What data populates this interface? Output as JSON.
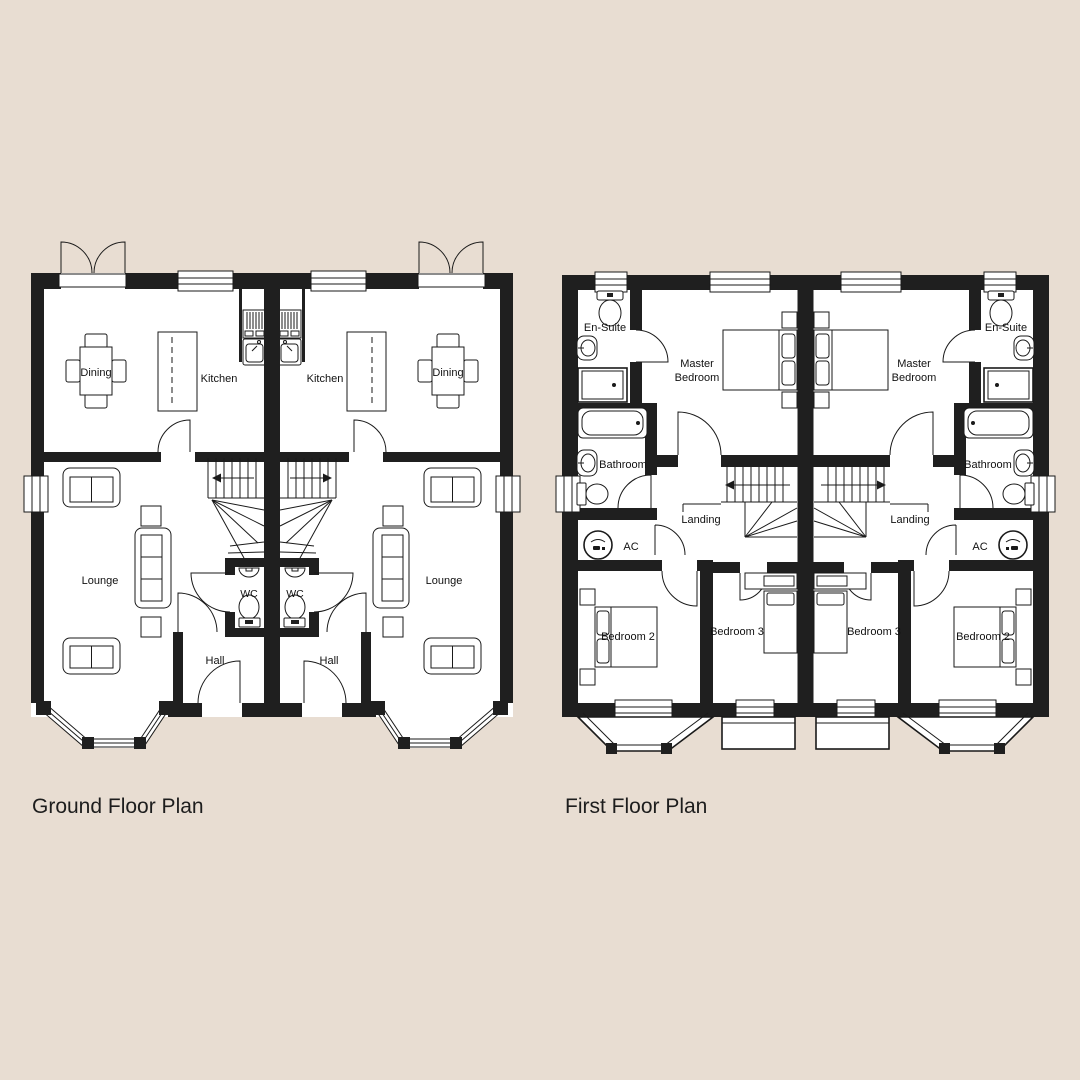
{
  "colors": {
    "background": "#e8ddd2",
    "wall": "#1f1f1f",
    "line": "#1a1a1a",
    "floor": "#ffffff",
    "label": "#111111",
    "title": "#1d1d1d"
  },
  "plans": {
    "ground": {
      "title": "Ground Floor Plan",
      "rooms": {
        "dining": "Dining",
        "kitchen": "Kitchen",
        "lounge": "Lounge",
        "wc": "WC",
        "hall": "Hall"
      }
    },
    "first": {
      "title": "First Floor Plan",
      "rooms": {
        "ensuite": "En-Suite",
        "master_bedroom": [
          "Master",
          "Bedroom"
        ],
        "bathroom": "Bathroom",
        "landing": "Landing",
        "ac": "AC",
        "bedroom2": "Bedroom 2",
        "bedroom3": "Bedroom 3"
      }
    }
  }
}
